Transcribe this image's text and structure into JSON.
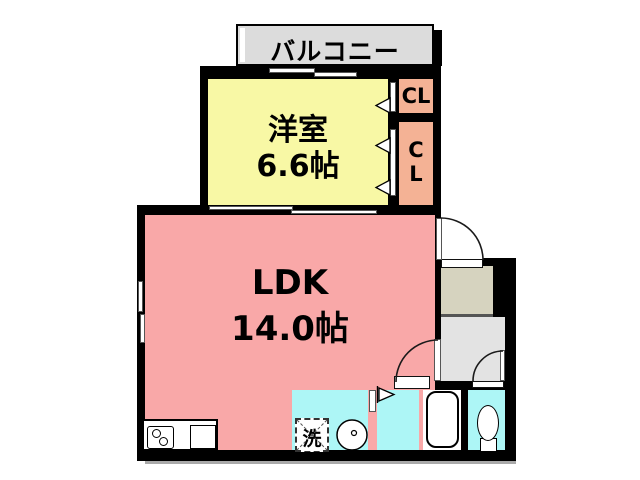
{
  "plan_type": "apartment-floor-plan",
  "balcony": {
    "label": "バルコニー"
  },
  "rooms": {
    "bedroom": {
      "label": "洋室",
      "size": "6.6帖"
    },
    "ldk": {
      "label": "LDK",
      "size": "14.0帖"
    },
    "closet_top": {
      "label": "CL"
    },
    "closet_bottom": {
      "line1": "C",
      "line2": "L"
    },
    "laundry": {
      "label": "洗"
    }
  },
  "fixtures": [
    "kitchen-stove",
    "kitchen-sink",
    "washing-machine",
    "wash-basin",
    "bathtub",
    "toilet"
  ],
  "colors": {
    "bedroom": "#f8f8a5",
    "ldk": "#f9a8a8",
    "closet": "#f4b295",
    "wet_rooms": "#adf6f6",
    "balcony": "#dcdcdc",
    "entry_floor": "#d6d3bf",
    "hall_floor": "#e3e3e3",
    "wall": "#000000"
  }
}
